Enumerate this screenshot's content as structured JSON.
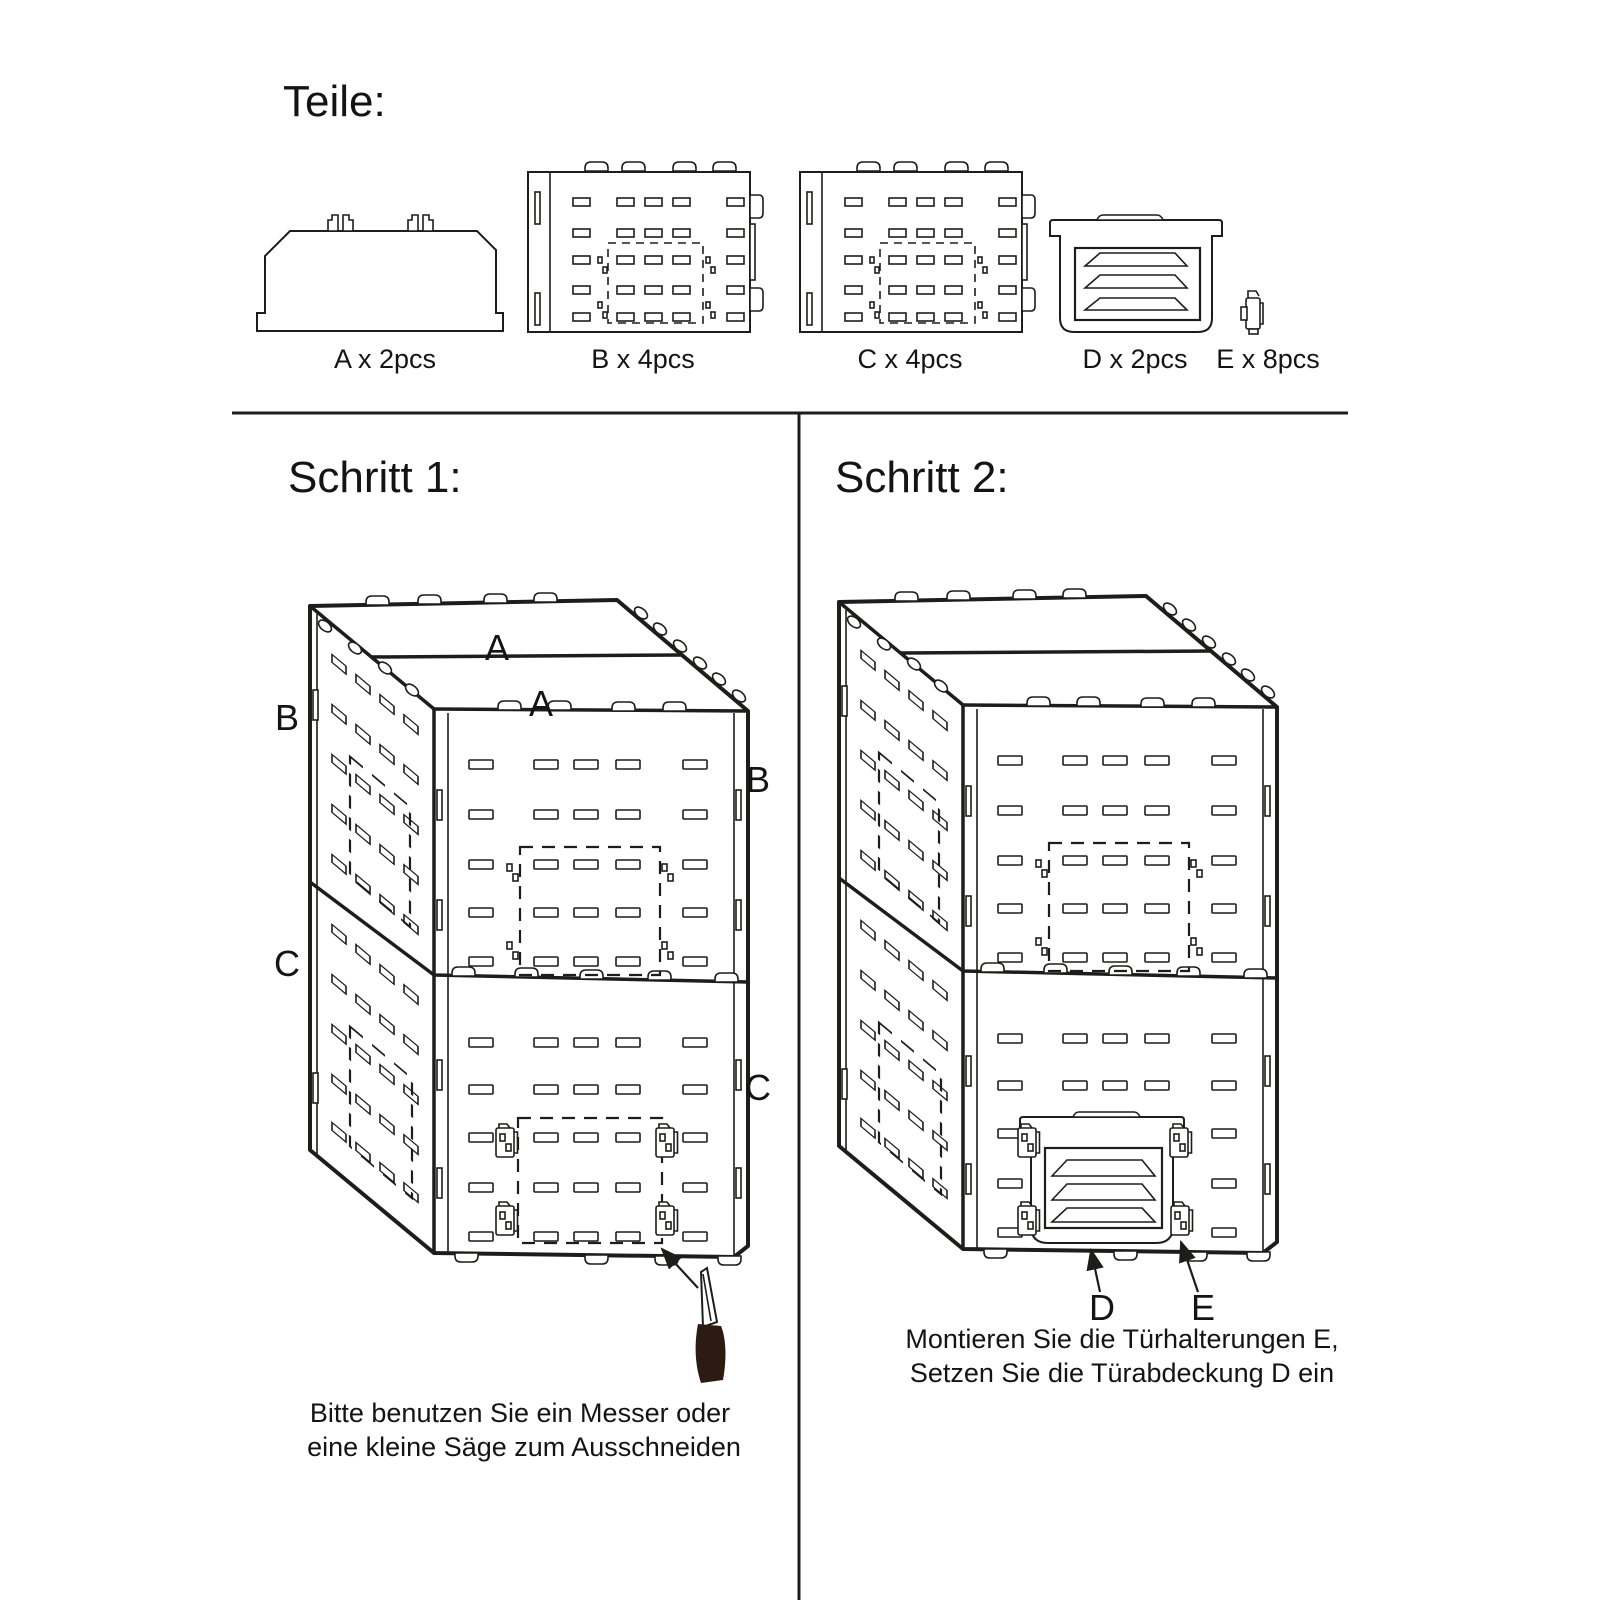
{
  "teile": {
    "title": "Teile:"
  },
  "parts": {
    "a": {
      "label": "A x 2pcs"
    },
    "b": {
      "label": "B x 4pcs"
    },
    "c": {
      "label": "C x 4pcs"
    },
    "d": {
      "label": "D x 2pcs"
    },
    "e": {
      "label": "E x 8pcs"
    }
  },
  "step1": {
    "title": "Schritt 1:",
    "label_a_top": "A",
    "label_a_front": "A",
    "label_b_left": "B",
    "label_b_right": "B",
    "label_c_left": "C",
    "label_c_right": "C",
    "note_line1": "Bitte benutzen Sie ein Messer oder",
    "note_line2": "eine kleine Säge zum Ausschneiden"
  },
  "step2": {
    "title": "Schritt 2:",
    "label_d": "D",
    "label_e": "E",
    "note_line1": "Montieren Sie die Türhalterungen E,",
    "note_line2": "Setzen Sie die Türabdeckung D ein"
  },
  "colors": {
    "line": "#1d1d1b",
    "knife_handle": "#2b1b13",
    "background": "#ffffff"
  }
}
